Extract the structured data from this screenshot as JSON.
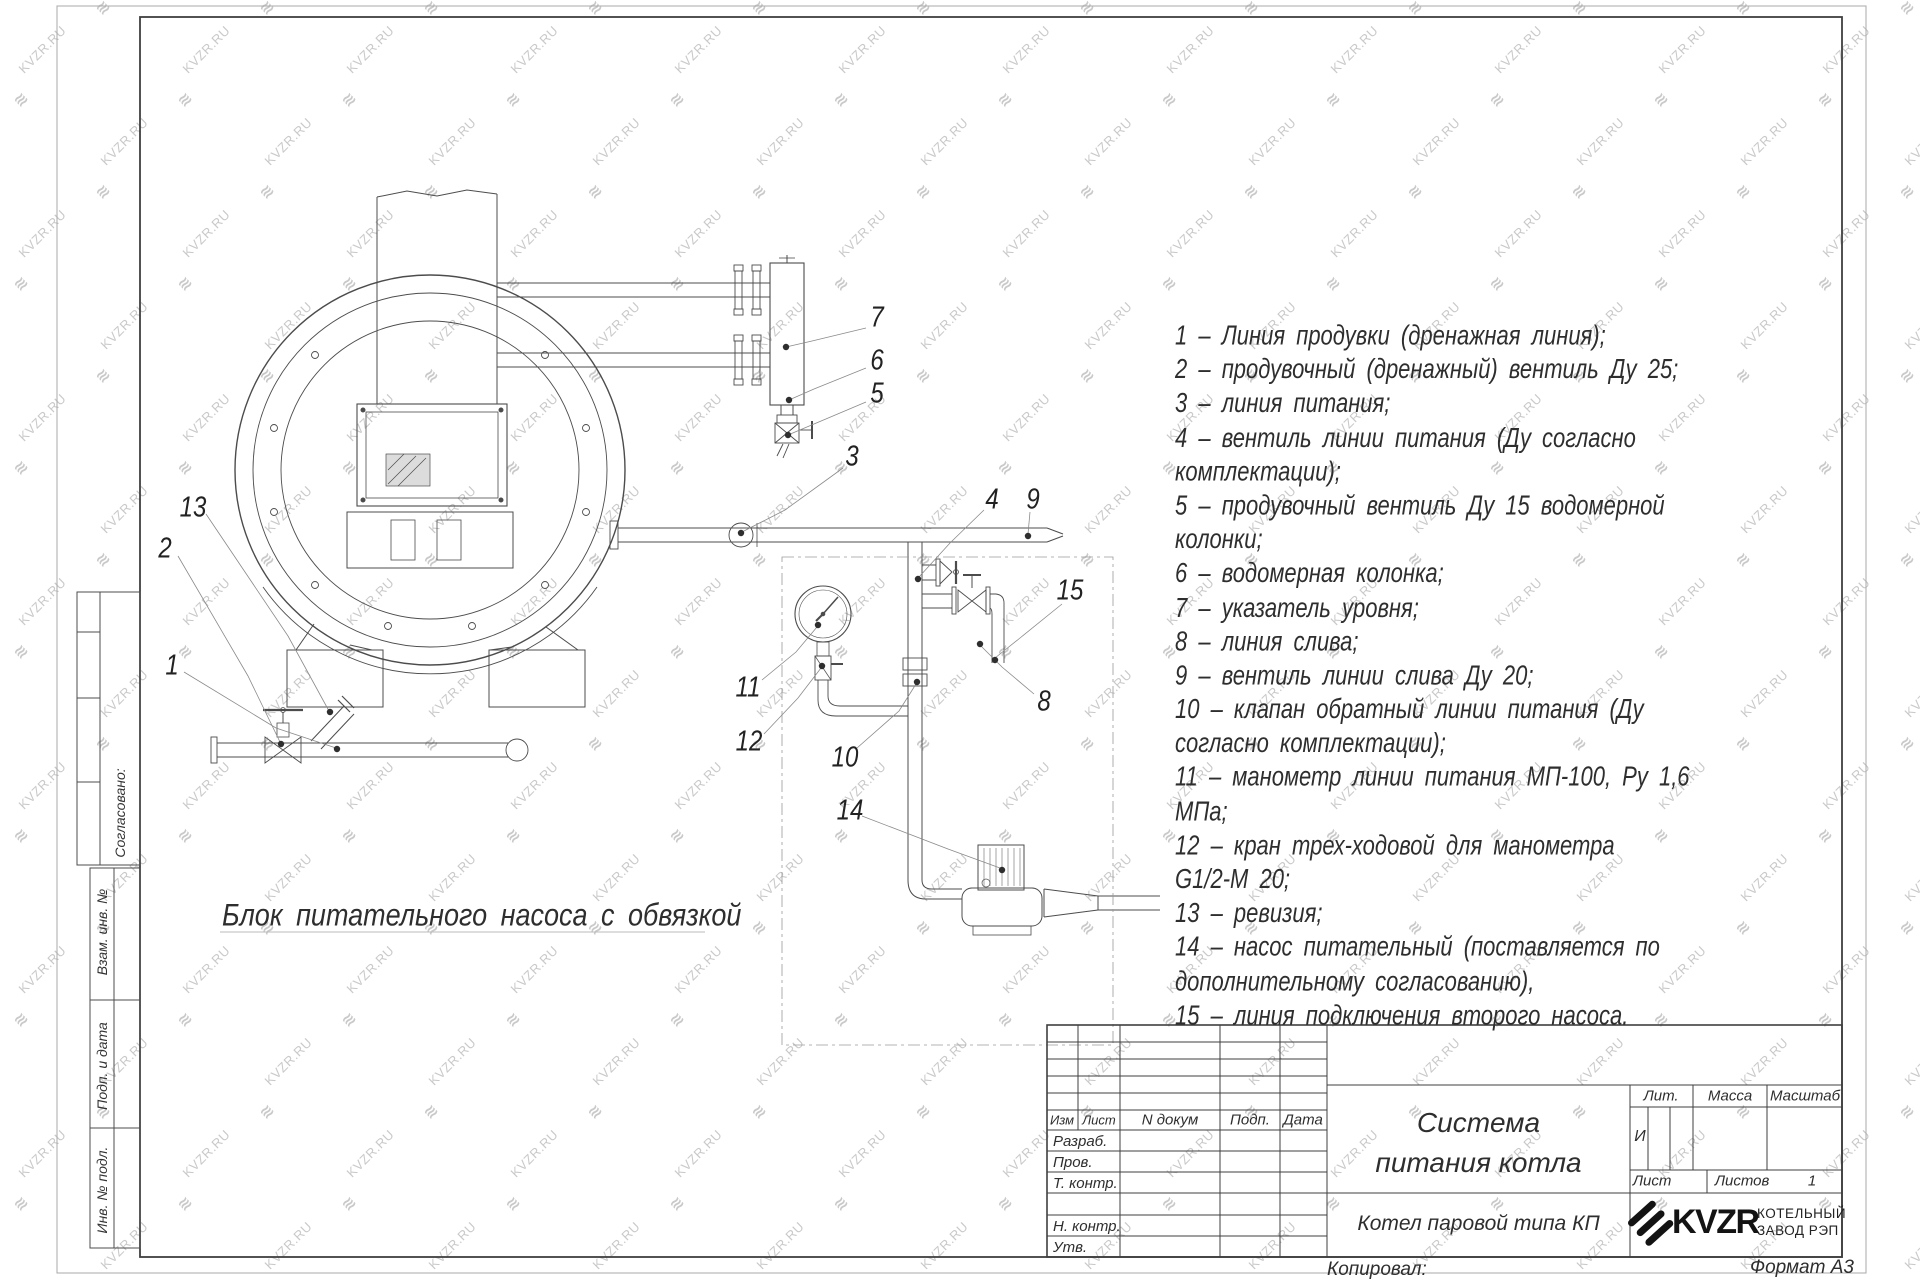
{
  "watermark": {
    "text": "KVZR.RU"
  },
  "page": {
    "drawing_caption": "Блок питательного насоса с обвязкой"
  },
  "callouts": {
    "c1": "1",
    "c2": "2",
    "c3": "3",
    "c4": "4",
    "c5": "5",
    "c6": "6",
    "c7": "7",
    "c8": "8",
    "c9": "9",
    "c10": "10",
    "c11": "11",
    "c12": "12",
    "c13": "13",
    "c14": "14",
    "c15": "15"
  },
  "legend": {
    "lines": [
      "1 – Линия продувки (дренажная линия);",
      "2 – продувочный (дренажный) вентиль Ду 25;",
      "3 – линия питания;",
      "4 – вентиль линии питания (Ду согласно",
      "комплектации);",
      "5 – продувочный вентиль Ду 15 водомерной",
      "колонки;",
      "6 – водомерная колонка;",
      "7 – указатель уровня;",
      "8 – линия слива;",
      "9 – вентиль линии слива Ду 20;",
      "10 – клапан обратный линии питания (Ду",
      "согласно комплектации);",
      "11 – манометр линии питания МП-100, Ру 1,6",
      "МПа;",
      "12 – кран трех-ходовой для манометра",
      "G1/2-М 20;",
      "13 – ревизия;",
      "14 – насос питательный (поставляется по",
      "дополнительному согласованию),",
      "15 – линия подключения второго насоса."
    ]
  },
  "side_column": {
    "agreed": "Согласовано:",
    "replace_inv": "Взам. инв. №",
    "sign_date": "Подп. и дата",
    "inv_orig": "Инв. № подл."
  },
  "title_block": {
    "col_izm": "Изм",
    "col_list": "Лист",
    "col_doc": "N докум",
    "col_sign": "Подп.",
    "col_date": "Дата",
    "row_developed": "Разраб.",
    "row_checked": "Пров.",
    "row_tcontrol": "Т. контр.",
    "row_ncontrol": "Н. контр.",
    "row_approved": "Утв.",
    "title_line1": "Система",
    "title_line2": "питания котла",
    "subtitle": "Котел паровой типа КП",
    "lit_label": "Лит.",
    "lit_value": "И",
    "mass_label": "Масса",
    "scale_label": "Масштаб",
    "sheet_label": "Лист",
    "sheets_label": "Листов",
    "sheets_value": "1",
    "company_logo": "KVZR",
    "company_line1": "КОТЕЛЬНЫЙ",
    "company_line2": "ЗАВОД РЭП",
    "copied": "Копировал:",
    "format": "Формат А3"
  }
}
